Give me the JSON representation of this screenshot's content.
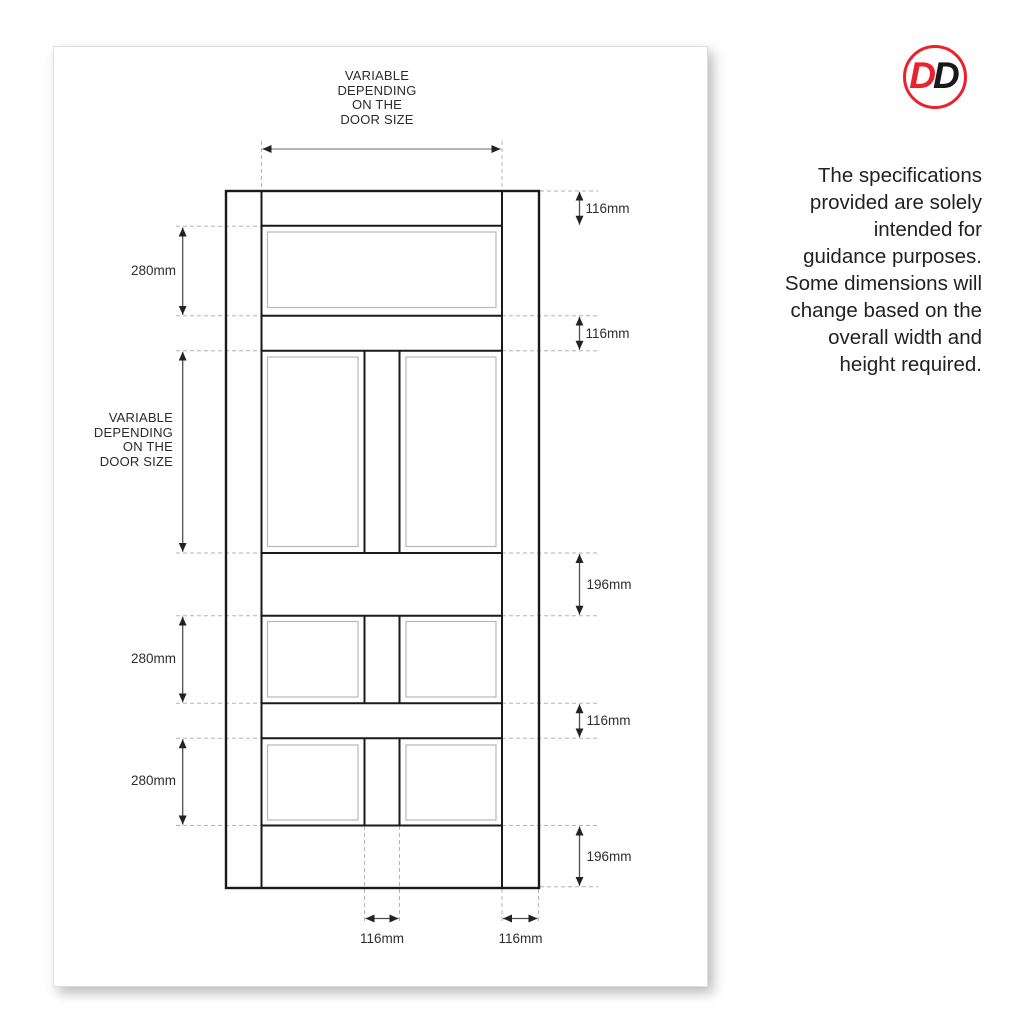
{
  "logo": {
    "letters": [
      "D",
      "D"
    ],
    "ring_color": "#e8232d",
    "d1_color": "#e8232d",
    "d2_color": "#191919"
  },
  "note": {
    "lines": [
      "The specifications",
      "provided are solely",
      "intended for",
      "guidance purposes.",
      "Some dimensions will",
      "change based on the",
      "overall width and",
      "height required."
    ]
  },
  "diagram": {
    "top_width_label": {
      "lines": [
        "VARIABLE",
        "DEPENDING",
        "ON THE",
        "DOOR SIZE"
      ]
    },
    "left_height_label": {
      "lines": [
        "VARIABLE",
        "DEPENDING",
        "ON THE",
        "DOOR SIZE"
      ]
    },
    "dims": {
      "top_rail": "116mm",
      "top_panel_height": "280mm",
      "second_rail": "116mm",
      "middle_rail": "196mm",
      "middle_panel_height": "280mm",
      "fourth_rail": "116mm",
      "lower_panel_height": "280mm",
      "bottom_rail": "196mm",
      "centre_stile_width": "116mm",
      "right_stile_width": "116mm"
    },
    "colors": {
      "door_line": "#1a1a1a",
      "panel_line": "#b8b8b8",
      "dash_line": "#b3b3b3",
      "dim_line": "#4f4f4f"
    }
  }
}
